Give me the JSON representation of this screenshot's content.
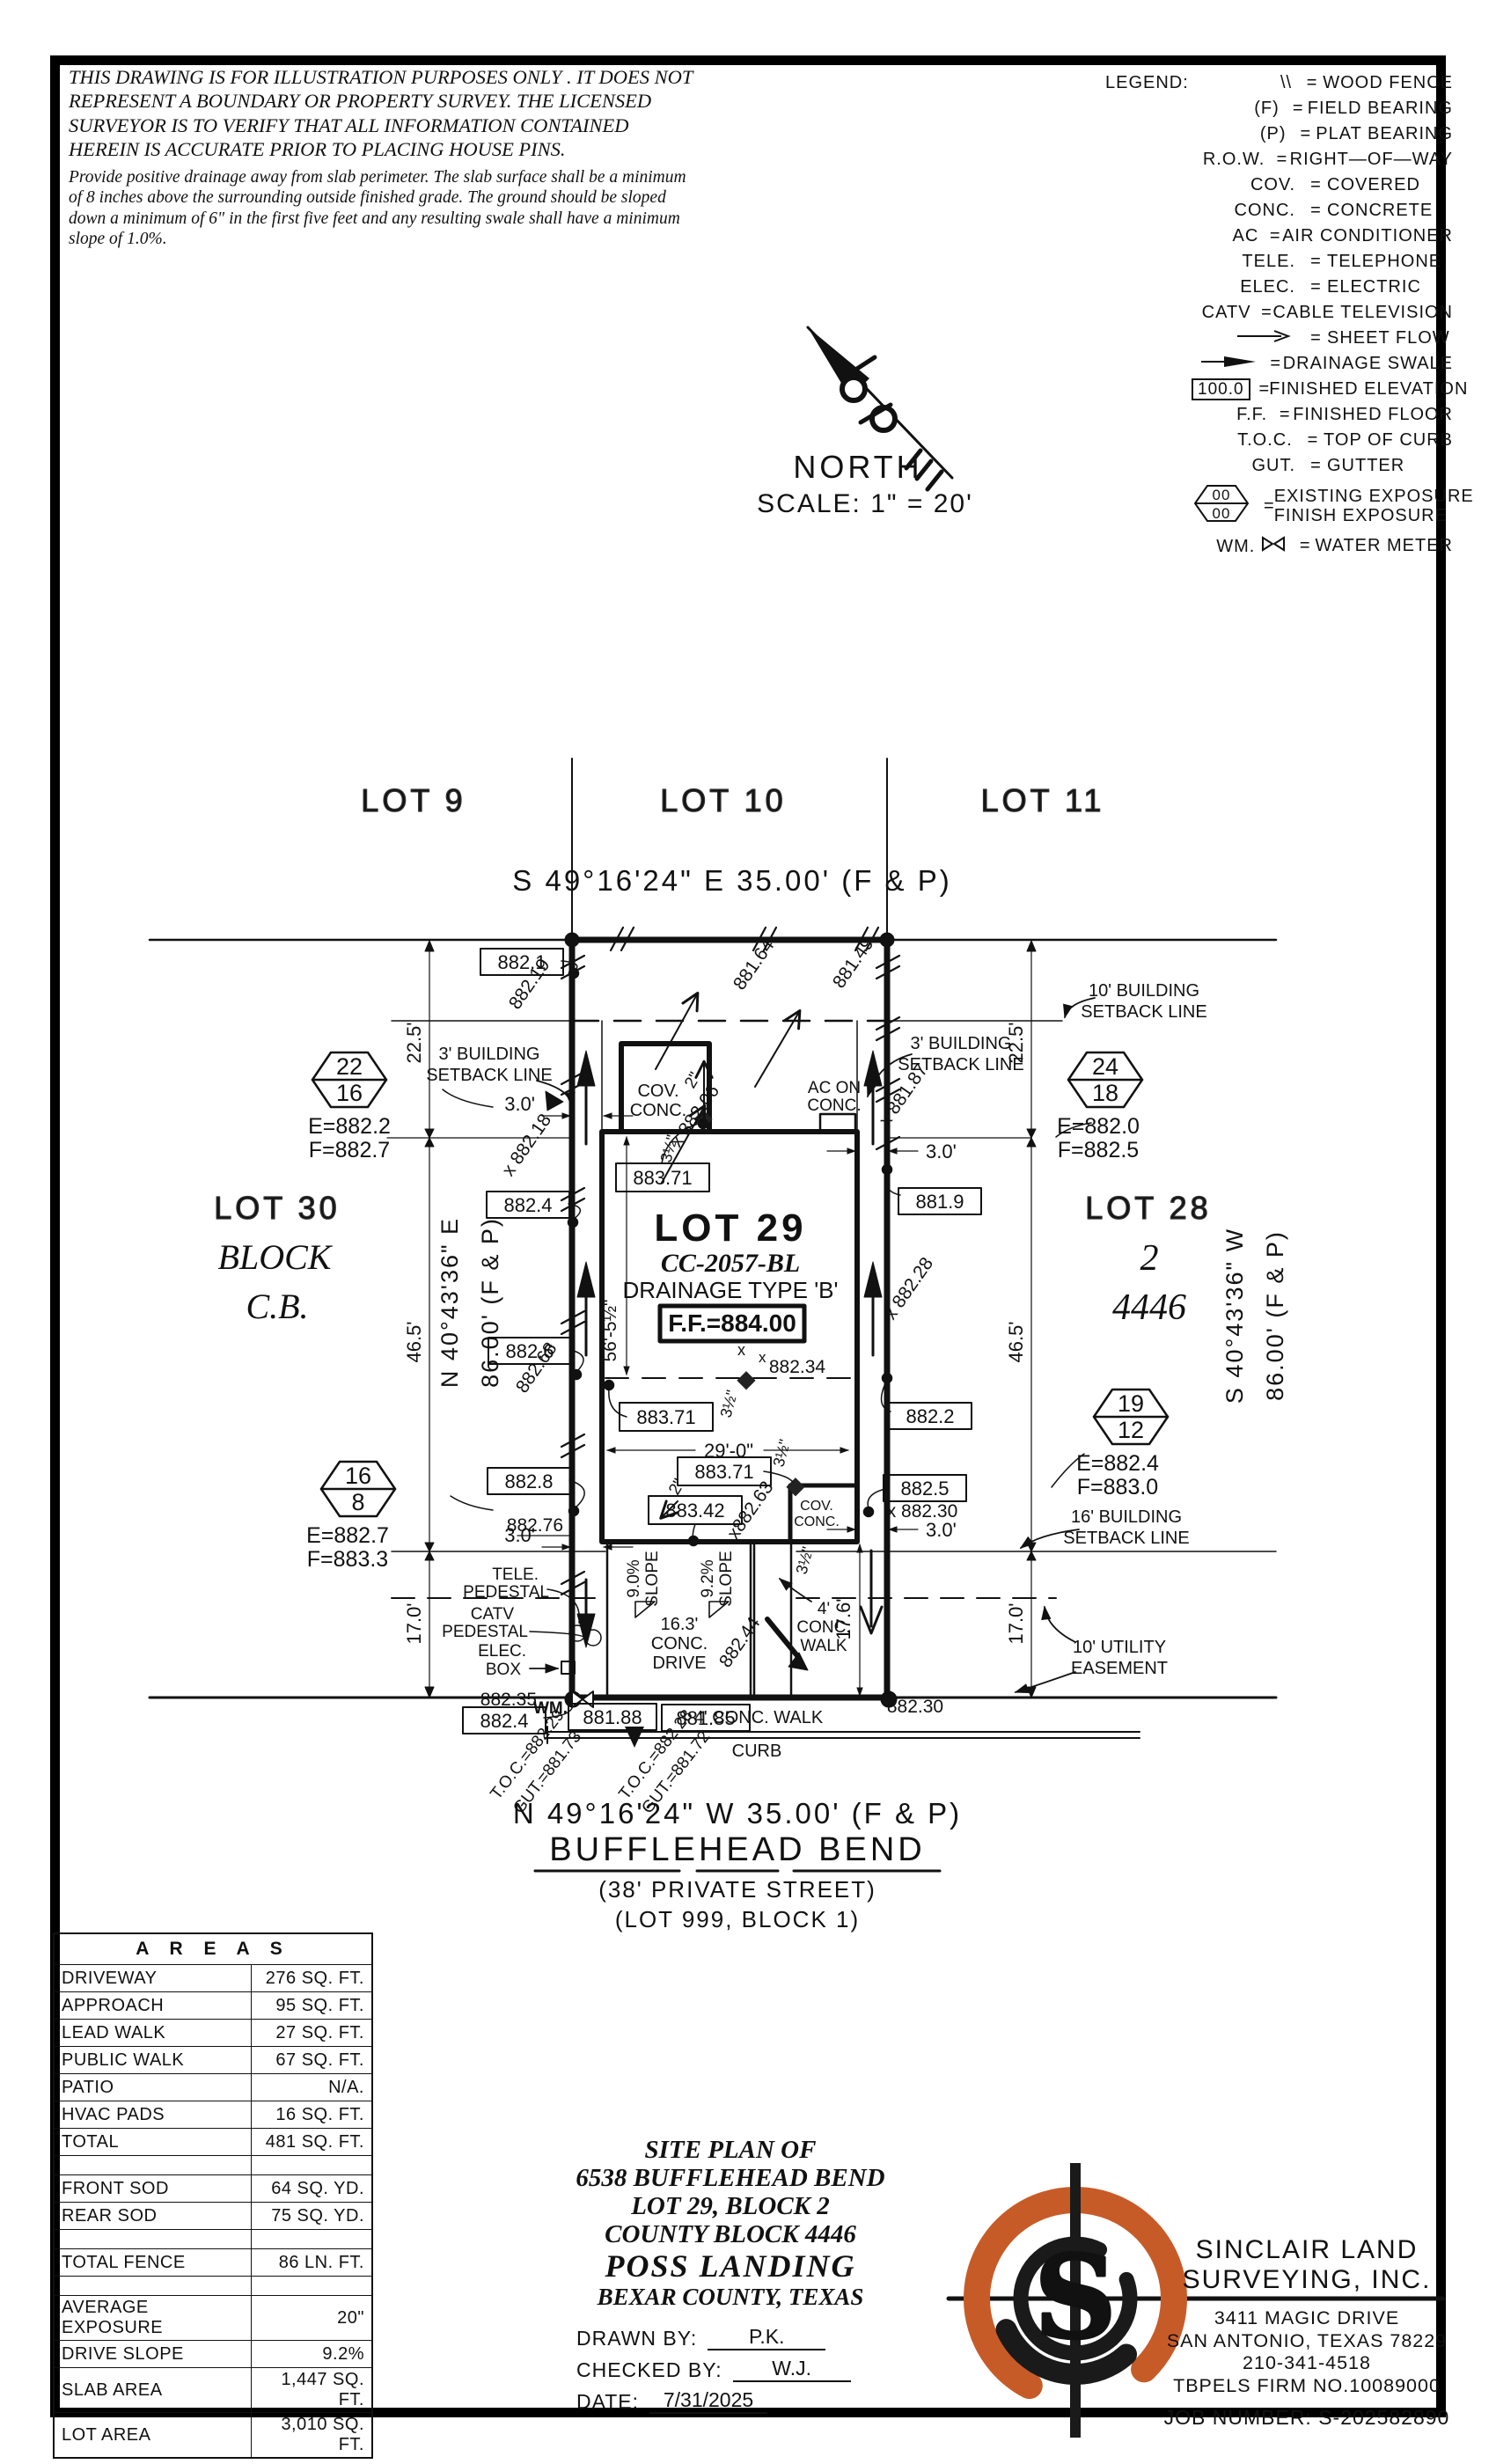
{
  "page": {
    "ink": "#111111",
    "accent_orange": "#C75B28",
    "bg": "#ffffff"
  },
  "disclaimer": {
    "para1": "THIS DRAWING IS FOR ILLUSTRATION PURPOSES ONLY . IT DOES NOT REPRESENT A BOUNDARY OR PROPERTY SURVEY. THE LICENSED SURVEYOR IS TO VERIFY THAT ALL INFORMATION CONTAINED HEREIN IS ACCURATE PRIOR TO PLACING HOUSE PINS.",
    "para2": "Provide positive drainage away from slab perimeter. The slab surface shall be a minimum of 8 inches above the surrounding outside finished grade. The ground should be sloped down a minimum of 6\" in the first five feet and any resulting swale shall have a minimum slope of 1.0%."
  },
  "legend": {
    "title": "LEGEND:",
    "items": [
      {
        "kind": "wood",
        "sym": "\\\\",
        "text": "WOOD FENCE"
      },
      {
        "kind": "text",
        "sym": "(F)",
        "text": "FIELD BEARING"
      },
      {
        "kind": "text",
        "sym": "(P)",
        "text": "PLAT BEARING"
      },
      {
        "kind": "text",
        "sym": "R.O.W.",
        "text": "RIGHT—OF—WAY"
      },
      {
        "kind": "text",
        "sym": "COV.",
        "text": "COVERED"
      },
      {
        "kind": "text",
        "sym": "CONC.",
        "text": "CONCRETE"
      },
      {
        "kind": "text",
        "sym": "AC",
        "text": "AIR CONDITIONER"
      },
      {
        "kind": "text",
        "sym": "TELE.",
        "text": "TELEPHONE"
      },
      {
        "kind": "text",
        "sym": "ELEC.",
        "text": "ELECTRIC"
      },
      {
        "kind": "text",
        "sym": "CATV",
        "text": "CABLE TELEVISION"
      },
      {
        "kind": "arrow",
        "sym": "",
        "text": "SHEET FLOW"
      },
      {
        "kind": "swale",
        "sym": "",
        "text": "DRAINAGE SWALE"
      },
      {
        "kind": "box",
        "sym": "100.0",
        "text": "FINISHED ELEVATION"
      },
      {
        "kind": "text",
        "sym": "F.F.",
        "text": "FINISHED FLOOR"
      },
      {
        "kind": "text",
        "sym": "T.O.C.",
        "text": "TOP OF CURB"
      },
      {
        "kind": "text",
        "sym": "GUT.",
        "text": "GUTTER"
      },
      {
        "kind": "hex",
        "sym": "00",
        "sym2": "00",
        "text": "EXISTING EXPOSURE",
        "text2": "FINISH EXPOSURE"
      },
      {
        "kind": "wm",
        "sym": "WM.",
        "text": "WATER METER"
      }
    ]
  },
  "north": {
    "label": "NORTH",
    "scale": "SCALE: 1\" = 20'"
  },
  "plan": {
    "xmark": "x",
    "lot9": "LOT 9",
    "lot10": "LOT 10",
    "lot11": "LOT 11",
    "lot30": "LOT 30",
    "block_lbl": "BLOCK",
    "cb_lbl": "C.B.",
    "lot28": "LOT 28",
    "blk2": "2",
    "cb4446": "4446",
    "lot29": "LOT 29",
    "cc": "CC-2057-BL",
    "dtype": "DRAINAGE TYPE 'B'",
    "ff": "F.F.=884.00",
    "rear_bearing": "S 49°16'24\" E 35.00' (F & P)",
    "front_bearing": "N 49°16'24\" W 35.00' (F & P)",
    "left_brg1": "N 40°43'36\" E",
    "left_brg2": "86.00' (F & P)",
    "right_brg1": "S 40°43'36\" W",
    "right_brg2": "86.00' (F & P)",
    "street": "BUFFLEHEAD BEND",
    "street_sub1": "(38' PRIVATE STREET)",
    "street_sub2": "(LOT 999, BLOCK 1)",
    "d225": "22.5'",
    "d465": "46.5'",
    "d170": "17.0'",
    "d30": "3.0'",
    "d565": "56'-5½\"",
    "d290": "29'-0\"",
    "d176": "17.6'",
    "d2": "2\"",
    "d35": "3½\"",
    "sb3a": "3' BUILDING",
    "sb10a": "10' BUILDING",
    "sb16a": "16' BUILDING",
    "sbb": "SETBACK LINE",
    "uea": "10' UTILITY",
    "ueb": "EASEMENT",
    "hexA_top": "22",
    "hexA_bot": "16",
    "hexA_e": "E=882.2",
    "hexA_f": "F=882.7",
    "hexB_top": "24",
    "hexB_bot": "18",
    "hexB_e": "E=882.0",
    "hexB_f": "F=882.5",
    "hexC_top": "16",
    "hexC_bot": "8",
    "hexC_e": "E=882.7",
    "hexC_f": "F=883.3",
    "hexD_top": "19",
    "hexD_bot": "12",
    "hexD_e": "E=882.4",
    "hexD_f": "F=883.0",
    "b882_1": "882.1",
    "b882_4": "882.4",
    "b882_6": "882.6",
    "b882_8": "882.8",
    "b883_71": "883.71",
    "b883_42": "883.42",
    "b881_9": "881.9",
    "b882_2": "882.2",
    "b882_5": "882.5",
    "b881_88": "881.88",
    "b881_85": "881.85",
    "f882_19": "882.19",
    "f882_18": "x 882.18",
    "f882_68": "882.68",
    "f881_64": "881.64",
    "f881_49": "881.49",
    "f882_06": "x 882.06",
    "f881_87": "x 881.87",
    "f882_28": "x 882.28",
    "f882_63": "x882.63",
    "f882_44": "882.44",
    "f882_34": "882.34",
    "f882_30r": "x 882.30",
    "f882_30b": "882.30",
    "f882_35": "882.35",
    "f882_76": "882.76",
    "ac1": "AC ON",
    "ac2": "CONC.",
    "cov1": "COV.",
    "cov2": "CONC.",
    "tele1": "TELE.",
    "tele2": "PEDESTAL",
    "catv1": "CATV",
    "catv2": "PEDESTAL",
    "elec1": "ELEC.",
    "elec2": "BOX",
    "wm": "WM.",
    "curb": "CURB",
    "walk_h": "4' CONC. WALK",
    "walk_v1": "4'",
    "walk_v2": "CONC.",
    "walk_v3": "WALK",
    "drive1": "16.3'",
    "drive2": "CONC.",
    "drive3": "DRIVE",
    "sl90": "9.0%",
    "sl92": "9.2%",
    "slope": "SLOPE",
    "toc1": "T.O.C.=882.29",
    "gut1": "GUT.=881.73",
    "toc2": "T.O.C.=882.28",
    "gut2": "GUT.=881.72"
  },
  "areas": {
    "title": "A R E A S",
    "rows": [
      [
        "DRIVEWAY",
        "276 SQ. FT."
      ],
      [
        "APPROACH",
        "95 SQ. FT."
      ],
      [
        "LEAD WALK",
        "27 SQ. FT."
      ],
      [
        "PUBLIC WALK",
        "67 SQ. FT."
      ],
      [
        "PATIO",
        "N/A."
      ],
      [
        "HVAC PADS",
        "16 SQ. FT."
      ],
      [
        "TOTAL",
        "481 SQ. FT."
      ],
      [
        "",
        ""
      ],
      [
        "FRONT SOD",
        "64 SQ. YD."
      ],
      [
        "REAR SOD",
        "75 SQ. YD."
      ],
      [
        "",
        ""
      ],
      [
        "TOTAL FENCE",
        "86 LN. FT."
      ],
      [
        "",
        ""
      ],
      [
        "AVERAGE EXPOSURE",
        "20\""
      ],
      [
        "DRIVE SLOPE",
        "9.2%"
      ],
      [
        "SLAB AREA",
        "1,447 SQ. FT."
      ],
      [
        "LOT AREA",
        "3,010 SQ. FT."
      ]
    ]
  },
  "title_block": {
    "line1": "SITE PLAN OF",
    "line2": "6538 BUFFLEHEAD BEND",
    "line3": "LOT 29, BLOCK 2",
    "line4": "COUNTY BLOCK 4446",
    "line5": "POSS LANDING",
    "line6": "BEXAR COUNTY, TEXAS",
    "drawn_by_label": "DRAWN BY:",
    "drawn_by": "P.K.",
    "checked_by_label": "CHECKED BY:",
    "checked_by": "W.J.",
    "date_label": "DATE:",
    "date": "7/31/2025"
  },
  "company": {
    "name1": "SINCLAIR LAND",
    "name2": "SURVEYING, INC.",
    "addr1": "3411 MAGIC DRIVE",
    "addr2": "SAN ANTONIO, TEXAS 78229",
    "phone": "210-341-4518",
    "firm": "TBPELS FIRM NO.10089000",
    "job": "JOB NUMBER:  S-202582890",
    "logo_letter": "S"
  }
}
